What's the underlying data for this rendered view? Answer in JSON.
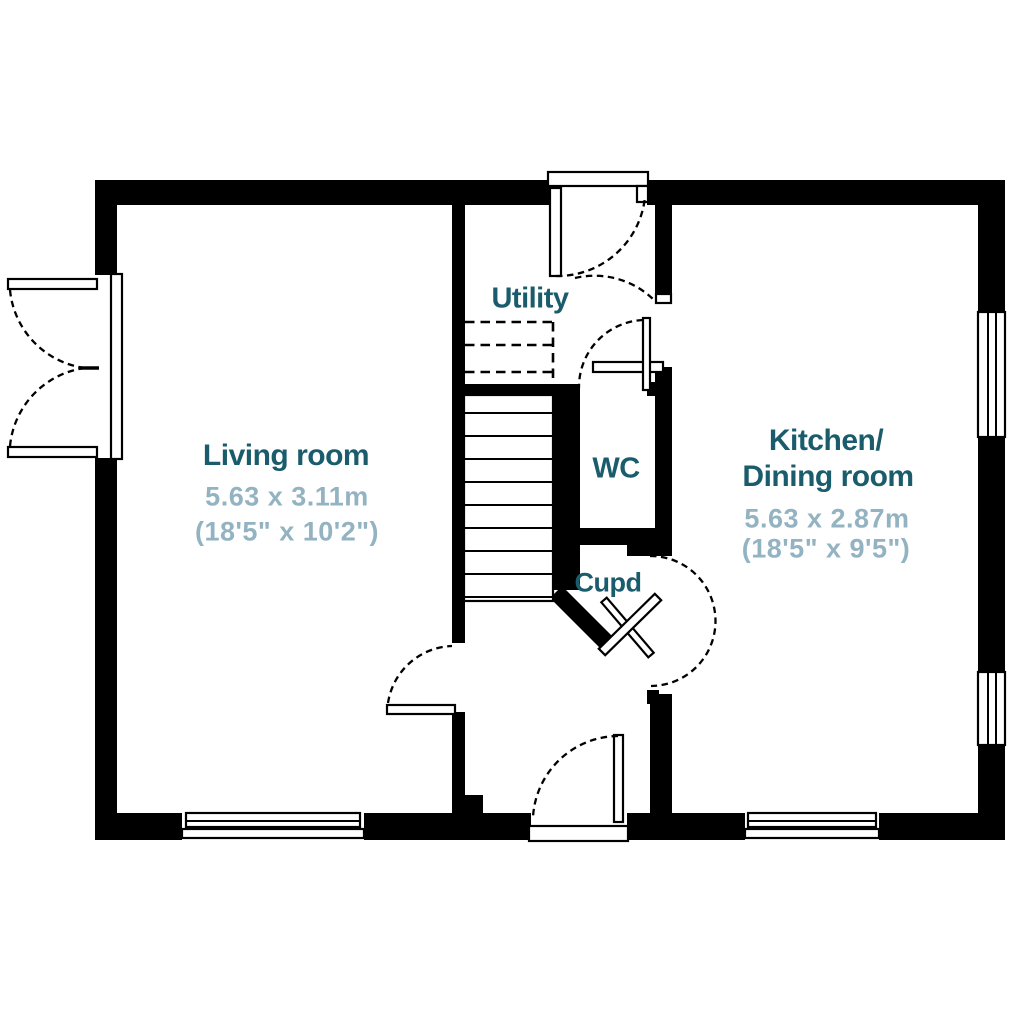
{
  "plan_type": "floor-plan",
  "colors": {
    "wall": "#000000",
    "background": "#ffffff",
    "room_label": "#1a5c6c",
    "dimension_label": "#93b3c2"
  },
  "rooms": {
    "living": {
      "name": "Living room",
      "metric": "5.63 x 3.11m",
      "imperial": "(18'5\" x 10'2\")"
    },
    "kitchen": {
      "name_line1": "Kitchen/",
      "name_line2": "Dining room",
      "metric": "5.63 x 2.87m",
      "imperial": "(18'5\" x 9'5\")"
    },
    "utility": {
      "name": "Utility"
    },
    "wc": {
      "name": "WC"
    },
    "cupboard": {
      "name": "Cupd"
    }
  }
}
